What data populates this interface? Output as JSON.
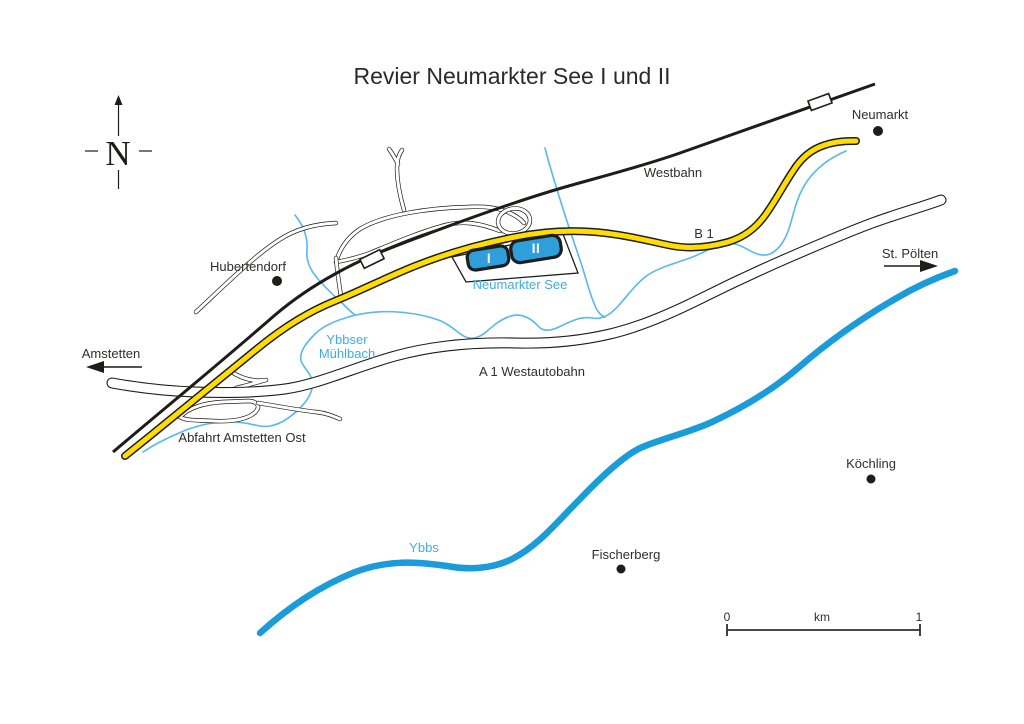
{
  "title": "Revier Neumarkter See I und II",
  "compass": {
    "letter": "N"
  },
  "colors": {
    "road_yellow": "#FFDD00",
    "river_blue": "#199CD9",
    "lake_blue": "#2E9FDB",
    "stream_blue": "#56B9EA",
    "water_label_blue": "#3FADE4",
    "line_black": "#1d1d1b"
  },
  "labels": {
    "westbahn": "Westbahn",
    "b1": "B 1",
    "a1": "A 1 Westautobahn",
    "neumarkter_see": "Neumarkter See",
    "lake1": "I",
    "lake2": "II",
    "ybbser_line1": "Ybbser",
    "ybbser_line2": "Mühlbach",
    "ybbs": "Ybbs",
    "abfahrt": "Abfahrt Amstetten Ost"
  },
  "places": {
    "neumarkt": "Neumarkt",
    "hubertendorf": "Hubertendorf",
    "koechling": "Köchling",
    "fischerberg": "Fischerberg"
  },
  "directions": {
    "amstetten": "Amstetten",
    "st_poelten": "St. Pölten"
  },
  "scalebar": {
    "start": "0",
    "unit": "km",
    "end": "1"
  }
}
